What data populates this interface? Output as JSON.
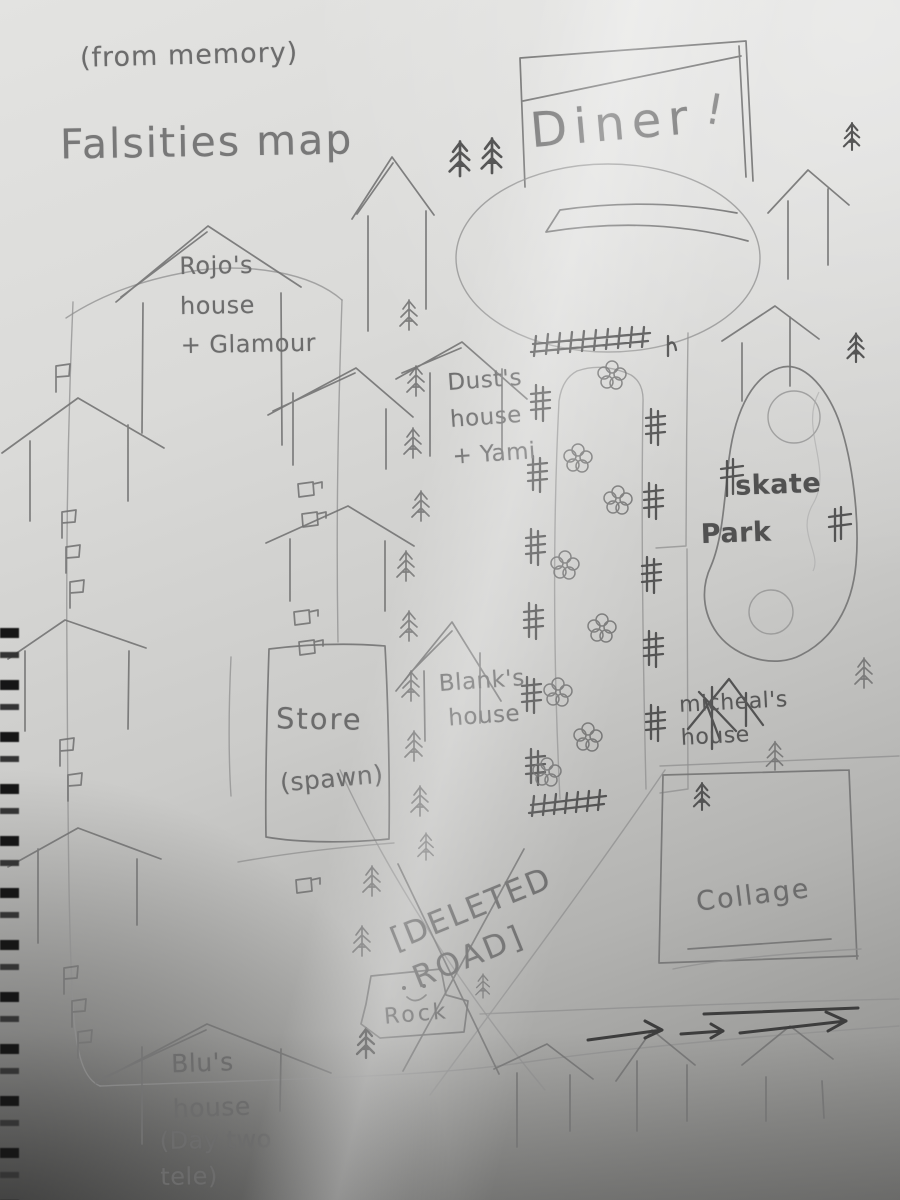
{
  "photo": {
    "kind": "hand-drawn pencil map on spiral notebook paper",
    "colors": {
      "paper_light": "#e3e3e1",
      "paper_dark": "#8a8a88",
      "pencil": "#737373",
      "pencil_dark": "#4a4a4a",
      "spiral_binding": "#161616"
    }
  },
  "header": {
    "note": "(from memory)",
    "title": "Falsities map"
  },
  "places": {
    "diner": "Diner",
    "diner_mark": "!",
    "rojos_house": "Rojo's\nhouse\n+ Glamour",
    "dusts_house": "Dust's\nhouse\n+ Yami",
    "store": "Store",
    "store_note": "(spawn)",
    "blanks_house": "Blank's\nhouse",
    "skate_park": "skate\nPark",
    "micheals_house": "micheal's\nhouse",
    "collage": "Collage",
    "deleted_road_line1": "[DELETED",
    "deleted_road_line2": "ROAD]",
    "rock": "Rock",
    "blus_house": "Blu's\nhouse",
    "blus_note": "(Day two\ntele)"
  }
}
